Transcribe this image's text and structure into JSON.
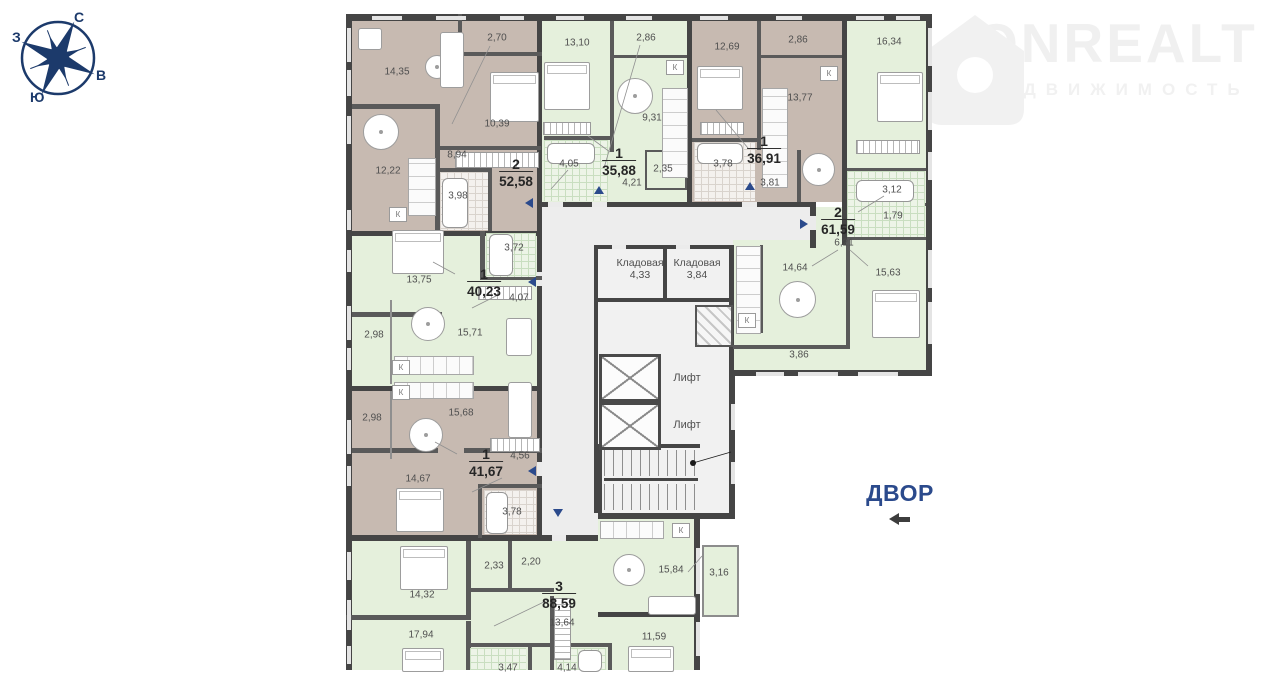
{
  "brand": {
    "name": "ONREALT",
    "subtitle": "НЕДВИЖИМОСТЬ"
  },
  "compass": {
    "north": "С",
    "south": "Ю",
    "west": "З",
    "east": "В"
  },
  "courtyard_label": "ДВОР",
  "kitchen_marker": "К",
  "core": {
    "storage_1": {
      "name": "Кладовая",
      "area": "4,33"
    },
    "storage_2": {
      "name": "Кладовая",
      "area": "3,84"
    },
    "lift_1": "Лифт",
    "lift_2": "Лифт"
  },
  "apartments": [
    {
      "rooms_count": "2",
      "total_area": "52,58",
      "rooms": [
        "14,35",
        "2,70",
        "10,39",
        "8,94",
        "12,22",
        "3,98"
      ]
    },
    {
      "rooms_count": "1",
      "total_area": "35,88",
      "rooms": [
        "13,10",
        "2,86",
        "9,31",
        "4,05",
        "2,35",
        "4,21"
      ]
    },
    {
      "rooms_count": "1",
      "total_area": "36,91",
      "rooms": [
        "12,69",
        "2,86",
        "13,77",
        "3,78",
        "3,81"
      ]
    },
    {
      "rooms_count": "2",
      "total_area": "61,59",
      "rooms": [
        "16,34",
        "3,12",
        "1,79",
        "6,21",
        "14,64",
        "15,63",
        "3,86"
      ]
    },
    {
      "rooms_count": "1",
      "total_area": "40,23",
      "rooms": [
        "13,75",
        "3,72",
        "4,07",
        "2,98",
        "15,71"
      ]
    },
    {
      "rooms_count": "1",
      "total_area": "41,67",
      "rooms": [
        "2,98",
        "15,68",
        "4,56",
        "14,67",
        "3,78"
      ]
    },
    {
      "rooms_count": "3",
      "total_area": "88,59",
      "rooms": [
        "14,32",
        "2,33",
        "2,20",
        "17,94",
        "13,64",
        "15,84",
        "3,16",
        "11,59",
        "3,47",
        "4,14"
      ]
    }
  ],
  "colors": {
    "accent_navy": "#2b4a8c",
    "apartment_green": "#e5f0dc",
    "apartment_taupe": "#c7bab1",
    "corridor_gray": "#ededed",
    "wall_dark": "#454545"
  }
}
